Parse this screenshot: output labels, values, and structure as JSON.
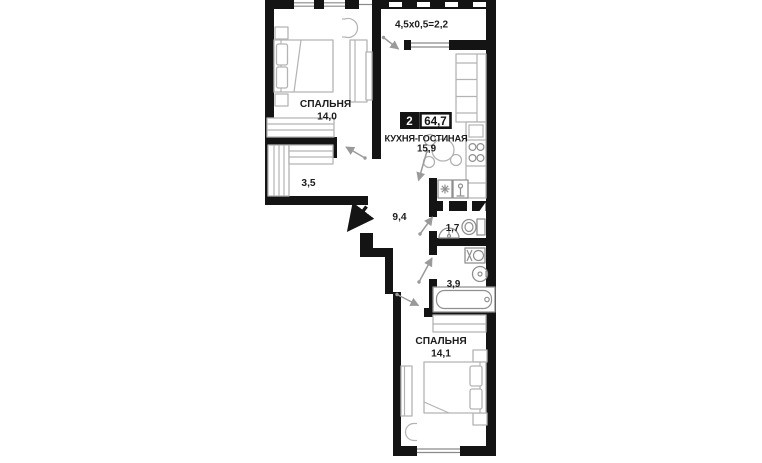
{
  "floorplan": {
    "badge": {
      "rooms_count": "2",
      "total_area": "64,7"
    },
    "balcony_dimension": "4,5x0,5=2,2",
    "rooms": {
      "bedroom_top": {
        "name": "СПАЛЬНЯ",
        "area": "14,0"
      },
      "kitchen_living": {
        "name": "КУХНЯ-ГОСТИНАЯ",
        "area": "15,9"
      },
      "wardrobe_room": {
        "area": "3,5"
      },
      "hallway": {
        "area": "9,4"
      },
      "wc": {
        "area": "1,7"
      },
      "bathroom": {
        "area": "3,9"
      },
      "bedroom_bottom": {
        "name": "СПАЛЬНЯ",
        "area": "14,1"
      }
    },
    "colors": {
      "background": "#ffffff",
      "walls": "#141414",
      "furniture_stroke": "#b3b3b3",
      "fixture_stroke": "#8f8f8f",
      "door_arrow": "#9a9a9a",
      "label_text": "#1c1c1c",
      "badge_bg": "#141414",
      "badge_text": "#ffffff"
    }
  }
}
